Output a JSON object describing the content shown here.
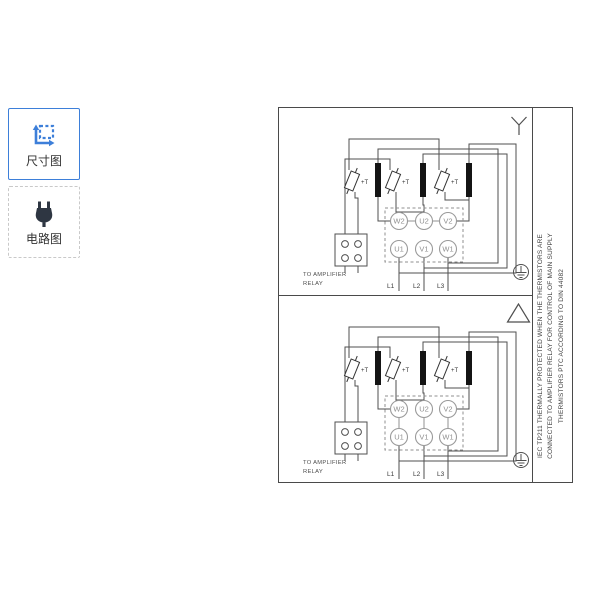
{
  "sidebar": {
    "buttons": [
      {
        "label": "尺寸图",
        "icon": "dimension-icon",
        "selected": true
      },
      {
        "label": "电路图",
        "icon": "plug-icon",
        "selected": false
      }
    ]
  },
  "wiring": {
    "thermistor_label": "+T",
    "relay_note_line1": "TO AMPLIFIER",
    "relay_note_line2": "RELAY",
    "terminals": {
      "w2": "W2",
      "u2": "U2",
      "v2": "V2",
      "u1": "U1",
      "v1": "V1",
      "w1": "W1"
    },
    "leads": {
      "l1": "L1",
      "l2": "L2",
      "l3": "L3"
    },
    "diagrams": [
      {
        "connection": "star"
      },
      {
        "connection": "delta"
      }
    ]
  },
  "side_note": {
    "line1": "IEC TP211 THERMALLY PROTECTED WHEN THE THERMISTORS ARE",
    "line2": "CONNECTED TO AMPLIFIER RELAY FOR CONTROL OF MAIN SUPPLY",
    "line3": "THERMISTORS PTC ACCORDING TO DIN 44082"
  },
  "colors": {
    "accent_blue": "#3d7fd9",
    "plug_dark": "#2e3642",
    "wire_gray": "#4f4f4f",
    "winding_black": "#141414",
    "terminal_gray": "#9a9a9a"
  }
}
